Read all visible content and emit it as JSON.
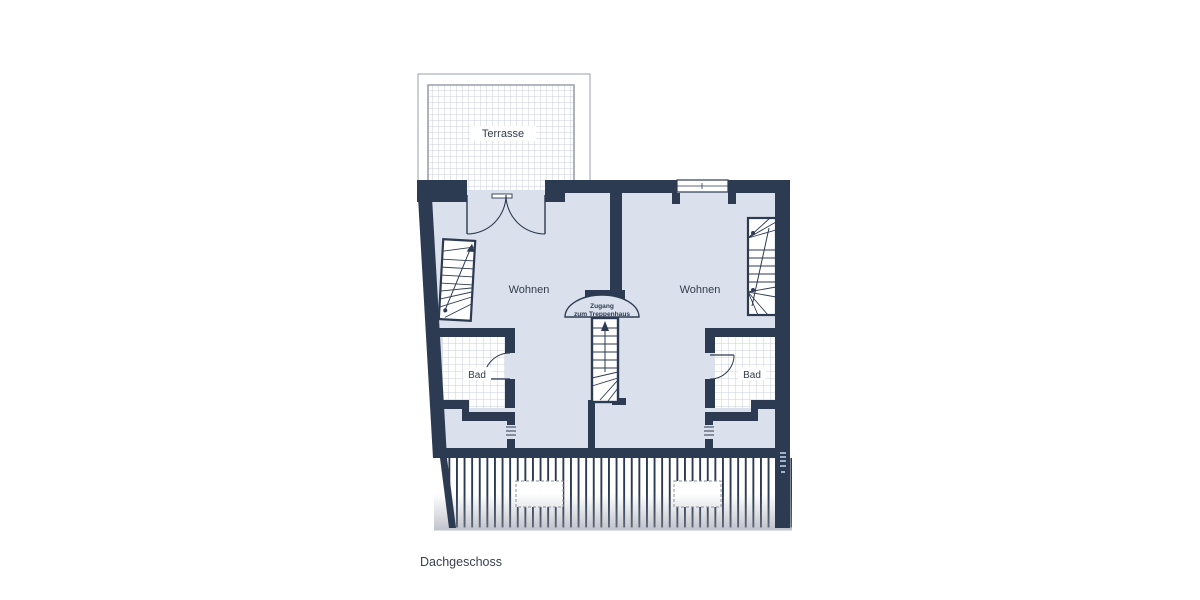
{
  "plan": {
    "terrace": {
      "label": "Terrasse"
    },
    "apartments": {
      "left": {
        "living": "Wohnen",
        "bath": "Bad"
      },
      "right": {
        "living": "Wohnen",
        "bath": "Bad"
      }
    },
    "stair_access": {
      "line1": "Zugang",
      "line2": "zum Treppenhaus"
    },
    "floor_label": "Dachgeschoss"
  },
  "colors": {
    "wall": "#2d3b52",
    "floor": "#dbe1ec",
    "tile_line": "#c9cfdb",
    "outline": "#9aa0ac",
    "text": "#333c4c",
    "watermark": "#9fb0cc"
  }
}
